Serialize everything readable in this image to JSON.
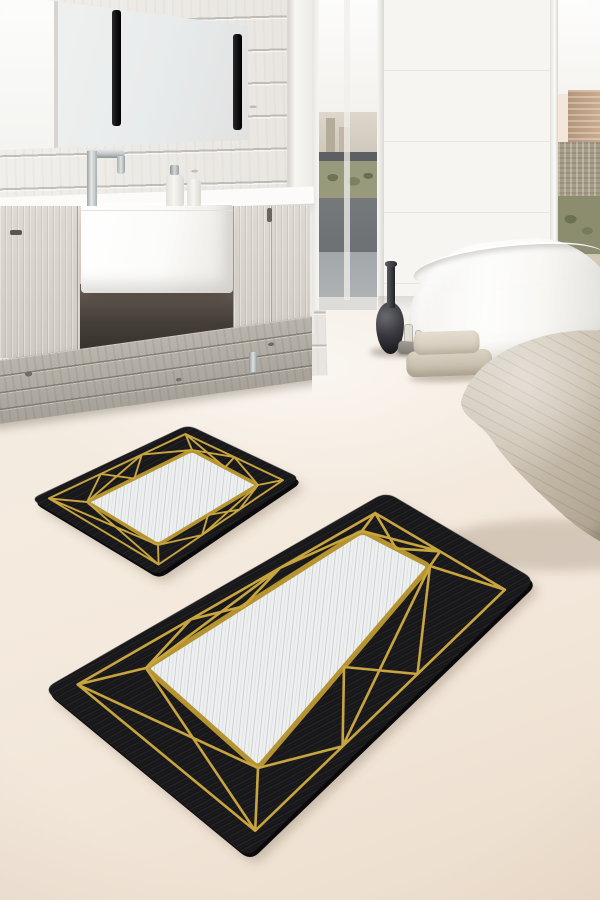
{
  "meta": {
    "title": "Product photo: two-piece black bath mat set with gold geometric line pattern and marbled white center panels, staged in a modern bathroom",
    "canvas": {
      "width": 600,
      "height": 900
    }
  },
  "scene": {
    "objects": [
      "white shiplap plank wall",
      "frameless mirror with two black vertical lamp strips",
      "chrome faucet",
      "white farmhouse sink on wall-hung light-wood vanity",
      "two white soap dispensers",
      "weathered gray wood plinth",
      "balcony glass door with city and tree view",
      "floor-to-ceiling window with skyline view",
      "freestanding white oval bathtub",
      "dark bottle-neck vase",
      "small glass bottles and gray stone tray",
      "stack of folded beige towels",
      "organic stone-shaped beige pouf",
      "large rectangular bath mat (black, gold geometric lines, white center)",
      "small rectangular bath mat (black, gold geometric lines, white center)"
    ]
  },
  "colors": {
    "floor": "#f2e7da",
    "plank": "#efedea",
    "pillar": "#f7f6f3",
    "wood": "#d9d5ce",
    "rustic": "#b4afa7",
    "counter": "#fcfbfa",
    "chrome": "#c2c6c8",
    "mirror": "#e9ecec",
    "black": "#141416",
    "tub": "#fdfdfc",
    "towel1": "#e0d9cb",
    "towel2": "#d3cabb",
    "vase": "#1c1c20",
    "foliage": "#8b8d6e",
    "panel_dark": "#75797c",
    "panel_mid": "#a2a7a9",
    "mat_black": "#17171a",
    "mat_panel": "#eef0f0",
    "gold": "#c9a53f",
    "gold_deep": "#b7932c",
    "pouf_light": "#dcd4c8",
    "pouf_dark": "#998c79"
  },
  "mats": {
    "description": "2-piece bath mat set: black ground, gold geometric triangle-web border, marbled white inner panel with gold trim",
    "frame_inset": 0.13,
    "pattern_segments": [
      [
        "F0",
        "F1"
      ],
      [
        "F1",
        "F2"
      ],
      [
        "F2",
        "F3"
      ],
      [
        "F3",
        "F0"
      ],
      [
        "F0",
        "P0"
      ],
      [
        "F1",
        "P1"
      ],
      [
        "F2",
        "P2"
      ],
      [
        "F3",
        "P3"
      ],
      [
        "P0",
        "FM0_38"
      ],
      [
        "FM0_38",
        "PE0_45"
      ],
      [
        "PE0_45",
        "FM0_68"
      ],
      [
        "FM0_68",
        "P1"
      ],
      [
        "P0",
        "FM0_68"
      ],
      [
        "FM1_50",
        "P1"
      ],
      [
        "FM1_50",
        "PE1_50"
      ],
      [
        "FM1_50",
        "P2"
      ],
      [
        "F1",
        "PE1_50"
      ],
      [
        "P2",
        "FM2_35"
      ],
      [
        "FM2_35",
        "PE2_50"
      ],
      [
        "PE2_50",
        "FM2_65"
      ],
      [
        "FM2_65",
        "P3"
      ],
      [
        "P2",
        "FM2_65"
      ],
      [
        "F3",
        "P0"
      ],
      [
        "F0",
        "P3"
      ]
    ],
    "items": [
      {
        "id": "bath-mat-large",
        "outer": [
          [
            44,
            689
          ],
          [
            386,
            492
          ],
          [
            535,
            580
          ],
          [
            248,
            857
          ]
        ],
        "panel": [
          [
            146,
            668
          ],
          [
            362,
            531
          ],
          [
            430,
            566
          ],
          [
            258,
            768
          ]
        ],
        "corner_radius": 12,
        "line_width": 2.6,
        "panel_stroke": 5
      },
      {
        "id": "bath-mat-small",
        "outer": [
          [
            31,
            499
          ],
          [
            188,
            425
          ],
          [
            300,
            478
          ],
          [
            157,
            575
          ]
        ],
        "panel": [
          [
            87,
            502
          ],
          [
            192,
            450
          ],
          [
            258,
            485
          ],
          [
            158,
            545
          ]
        ],
        "corner_radius": 9,
        "line_width": 1.9,
        "panel_stroke": 3.6
      }
    ]
  }
}
